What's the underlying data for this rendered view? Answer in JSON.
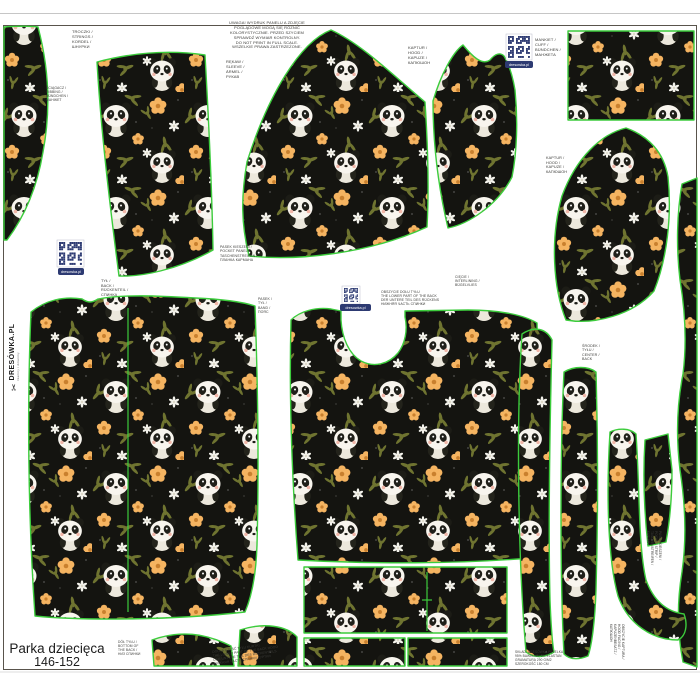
{
  "product": {
    "name": "Parka dziecięca",
    "size_range": "146-152"
  },
  "brand": {
    "logo_text": "DRESÓWKA.PL",
    "logo_tagline": "tkaniny i dzianiny",
    "qr_banner_label": "dresowka.pl",
    "scissors_icon": "scissors-icon"
  },
  "colors": {
    "piece_outline_green": "#3ccc3c",
    "fabric_background": "#141410",
    "flower_orange": "#f5b461",
    "leaf_olive": "#6f7430",
    "panel_border": "#59544c",
    "qr_navy": "#2d3a72",
    "page_background": "#ffffff"
  },
  "pieces": [
    "drawstring-sliver",
    "sleeve-left",
    "sleeve-main",
    "hood-top",
    "cuff-rectangle",
    "hood-side",
    "right-edge-strip",
    "back",
    "front-with-neck-opening",
    "mid-panel-rectangle",
    "hem-band-left",
    "hem-band-right",
    "trim-strip-a",
    "trim-strip-b",
    "trim-strip-j",
    "facing-quad",
    "bottom-wedge-a",
    "bottom-wedge-b"
  ],
  "labels": [
    {
      "name": "label-drawstring",
      "text": "TROCZKI /\nSTRINGS /\nKORDEL /\nШНУРКИ",
      "x": 72,
      "y": 30,
      "fs": 4,
      "rot": 0,
      "w": 0,
      "align": "left"
    },
    {
      "name": "label-ribbing",
      "text": "ŚCIĄGACZ /\nRIBBING /\nBÜNDCHEN /\nМАНЖЕТ",
      "x": 46,
      "y": 86,
      "fs": 3.4,
      "rot": 0,
      "w": 0,
      "align": "left"
    },
    {
      "name": "label-disclaimer",
      "text": "UWAGA! WYDRUK PANELU A ZDJĘCIE\nPOGLĄDOWE MOGĄ SIĘ RÓŻNIĆ\nKOLORYSTYCZNIE. PRZED SZYCIEM\nSPRAWDŹ WYMIAR KONTROLNY.\nDO NOT PRINT IN FULL SCALE.\nWSZELKIE PRAWA ZASTRZEŻONE.",
      "x": 211,
      "y": 21,
      "fs": 4,
      "rot": 0,
      "w": 112,
      "align": "center"
    },
    {
      "name": "label-sleeve",
      "text": "RĘKAW /\nSLEEVE /\nÄRMEL /\nРУКАВ",
      "x": 226,
      "y": 60,
      "fs": 4,
      "rot": 0,
      "w": 0,
      "align": "left"
    },
    {
      "name": "label-hood",
      "text": "KAPTUR /\nHOOD /\nKAPUZE /\nКАПЮШОН",
      "x": 408,
      "y": 46,
      "fs": 4,
      "rot": 0,
      "w": 0,
      "align": "left"
    },
    {
      "name": "label-cuff",
      "text": "MANKIET /\nCUFF /\nBÜNDCHEN /\nМАНЖЕТА",
      "x": 535,
      "y": 38,
      "fs": 4,
      "rot": 0,
      "w": 0,
      "align": "left"
    },
    {
      "name": "label-hood-side",
      "text": "KAPTUR /\nHOOD /\nKAPUZE /\nКАПЮШОН",
      "x": 546,
      "y": 156,
      "fs": 3.8,
      "rot": 0,
      "w": 0,
      "align": "left"
    },
    {
      "name": "label-pocket-strip",
      "text": "PASEK KIESZENI /\nPOCKET PANEL /\nTASCHENSTREIFEN /\nПЛАНКА КАРМАНА",
      "x": 220,
      "y": 245,
      "fs": 3.5,
      "rot": 0,
      "w": 0,
      "align": "left"
    },
    {
      "name": "label-back",
      "text": "TYŁ /\nBACK /\nRÜCKENTEIL /\nСПИНКА",
      "x": 101,
      "y": 279,
      "fs": 3.8,
      "rot": 0,
      "w": 0,
      "align": "left"
    },
    {
      "name": "label-band",
      "text": "PASEK /\nTYŁ /\nBAND /\nПОЯС",
      "x": 258,
      "y": 297,
      "fs": 3.5,
      "rot": 0,
      "w": 0,
      "align": "left"
    },
    {
      "name": "label-back-note",
      "text": "OBSZYCIE DOŁU TYŁU\nTHE LOWER PART OF THE BACK\nDER UNTERE TEIL DES RÜCKENS\nНИЖНЯЯ ЧАСТЬ СПИНКИ",
      "x": 381,
      "y": 290,
      "fs": 3.4,
      "rot": 0,
      "w": 60,
      "align": "left"
    },
    {
      "name": "label-interlining",
      "text": "CIĘCIE /\nINTERLINING /\nBÜGELVLIES",
      "x": 455,
      "y": 275,
      "fs": 3.4,
      "rot": 0,
      "w": 0,
      "align": "left"
    },
    {
      "name": "label-center-back",
      "text": "ŚRODEK /\nTYŁU /\nCENTER /\nBACK",
      "x": 582,
      "y": 344,
      "fs": 3.6,
      "rot": 0,
      "w": 0,
      "align": "left"
    },
    {
      "name": "label-bottom-back",
      "text": "DÓŁ TYŁU /\nBOTTOM OF\nTHE BACK /\nНИЗ СПИНКИ",
      "x": 118,
      "y": 640,
      "fs": 3.3,
      "rot": 0,
      "w": 0,
      "align": "left"
    },
    {
      "name": "label-lower-back-note",
      "text": "DOLNA CZĘŚĆ TYŁU KURTKI\nTHE LOWER PART OF THE BACK HOOD\nDER UNTERE TEIL DES RÜCKENTEILS\nНИЖНЯЯ ЧАСТЬ СПИНКИ КУРТКИ",
      "x": 212,
      "y": 650,
      "fs": 3.3,
      "rot": -8,
      "w": 95,
      "align": "left"
    },
    {
      "name": "label-fabric-info",
      "text": "SKŁAD: DRESÓWKA PĘTELKA\n95% BAWEŁNA, 5% ELASTAN\nGRAMATURA 290 G/M2\nSZEROKOŚĆ 180 CM",
      "x": 515,
      "y": 651,
      "fs": 3.2,
      "rot": 0,
      "w": 70,
      "align": "left"
    },
    {
      "name": "label-pocket-vertical",
      "text": "PASEK KIESZENI /\nPOCKET STRIP /\nTASCHENSTREIFEN /\nКАРМАН",
      "x": 661,
      "y": 531,
      "fs": 3.2,
      "rot": 90,
      "w": 0,
      "align": "left"
    },
    {
      "name": "label-hood-facing-vertical",
      "text": "OBSZYCIE KAPTURA /\nHOOD FACING /\nKAPUZENBESATZ /\nКАПЮШОН",
      "x": 624,
      "y": 624,
      "fs": 3.2,
      "rot": 90,
      "w": 0,
      "align": "left"
    }
  ],
  "qr_codes": [
    {
      "name": "qr-code-top",
      "x": 508,
      "y": 36,
      "size": 22,
      "banner": {
        "x": 505,
        "y": 61,
        "w": 28,
        "h": 7
      }
    },
    {
      "name": "qr-code-left",
      "x": 59,
      "y": 242,
      "size": 23,
      "banner": {
        "x": 58,
        "y": 268,
        "w": 26,
        "h": 7
      }
    },
    {
      "name": "qr-code-center",
      "x": 344,
      "y": 288,
      "size": 14,
      "banner": {
        "x": 340,
        "y": 304,
        "w": 31,
        "h": 7
      }
    }
  ]
}
